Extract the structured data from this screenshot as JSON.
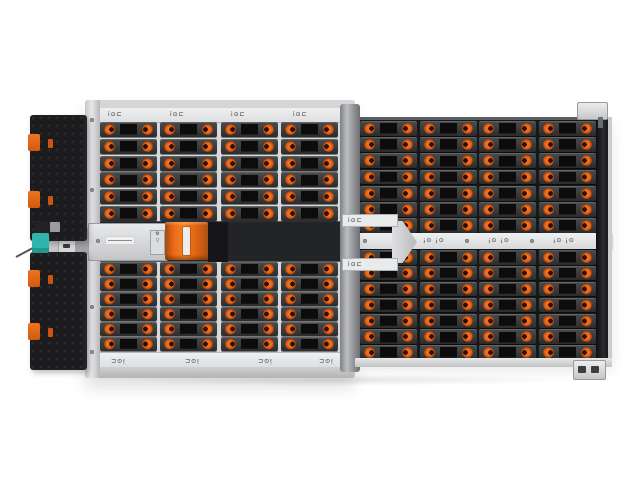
{
  "scene": {
    "description": "Top-down product photo of a high-density storage enclosure (JBOD) with orange drive latches",
    "background": "#ffffff"
  },
  "palette": {
    "chassis_silver": "#d7d9db",
    "rail_silver": "#e9eaec",
    "bay_black": "#17181a",
    "drive_slot_gray": "#3a3b3d",
    "latch_orange": "#f07020",
    "handle_orange": "#ee6c15",
    "release_teal": "#2fb5ab",
    "bezel_black": "#1c1c1e"
  },
  "left_bezel": {
    "top_panel_clips": 2,
    "bottom_panel_clips": 2,
    "inner_marks_per_panel": 2
  },
  "zones": {
    "left": {
      "columns": 4,
      "rows_top": 6,
      "rows_bottom": 6,
      "drive_count": 48,
      "rail_glyph": "i⊙⊏",
      "rail_marks_top": 4,
      "rail_marks_bottom": 4
    },
    "right": {
      "columns": 4,
      "rows_top": 7,
      "rows_bottom": 7,
      "drive_count": 56,
      "fan_strip_glyph": "¡⊙ ¡⊙",
      "fan_strip_groups": 3,
      "fan_strip_screws": 5
    }
  },
  "mid_bay": {
    "psu_modules": 1,
    "iom_modules": 2,
    "iom_connectors_per_module": 2,
    "iom_io_chip_glyph": "i⊙⊏"
  }
}
